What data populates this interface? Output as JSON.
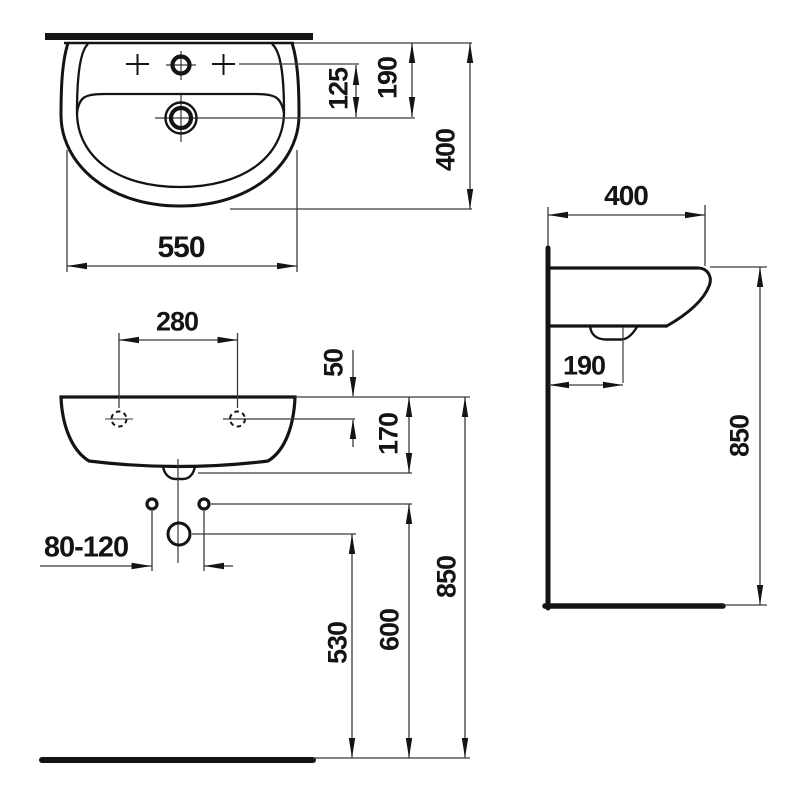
{
  "colors": {
    "line": "#141414",
    "thin_line": "#3a3a3a",
    "background": "#ffffff"
  },
  "labels": {
    "plan_width": "550",
    "plan_tap_to_drain": "125",
    "plan_wall_to_drain": "190",
    "plan_depth": "400",
    "front_tap_hole_spacing": "280",
    "front_rim_to_holes": "50",
    "front_rim_to_underside": "170",
    "front_supply_spacing": "80-120",
    "front_outlet_height": "530",
    "front_supply_height": "600",
    "front_rim_height": "850",
    "side_depth": "400",
    "side_wall_to_drain": "190",
    "side_rim_height": "850"
  }
}
